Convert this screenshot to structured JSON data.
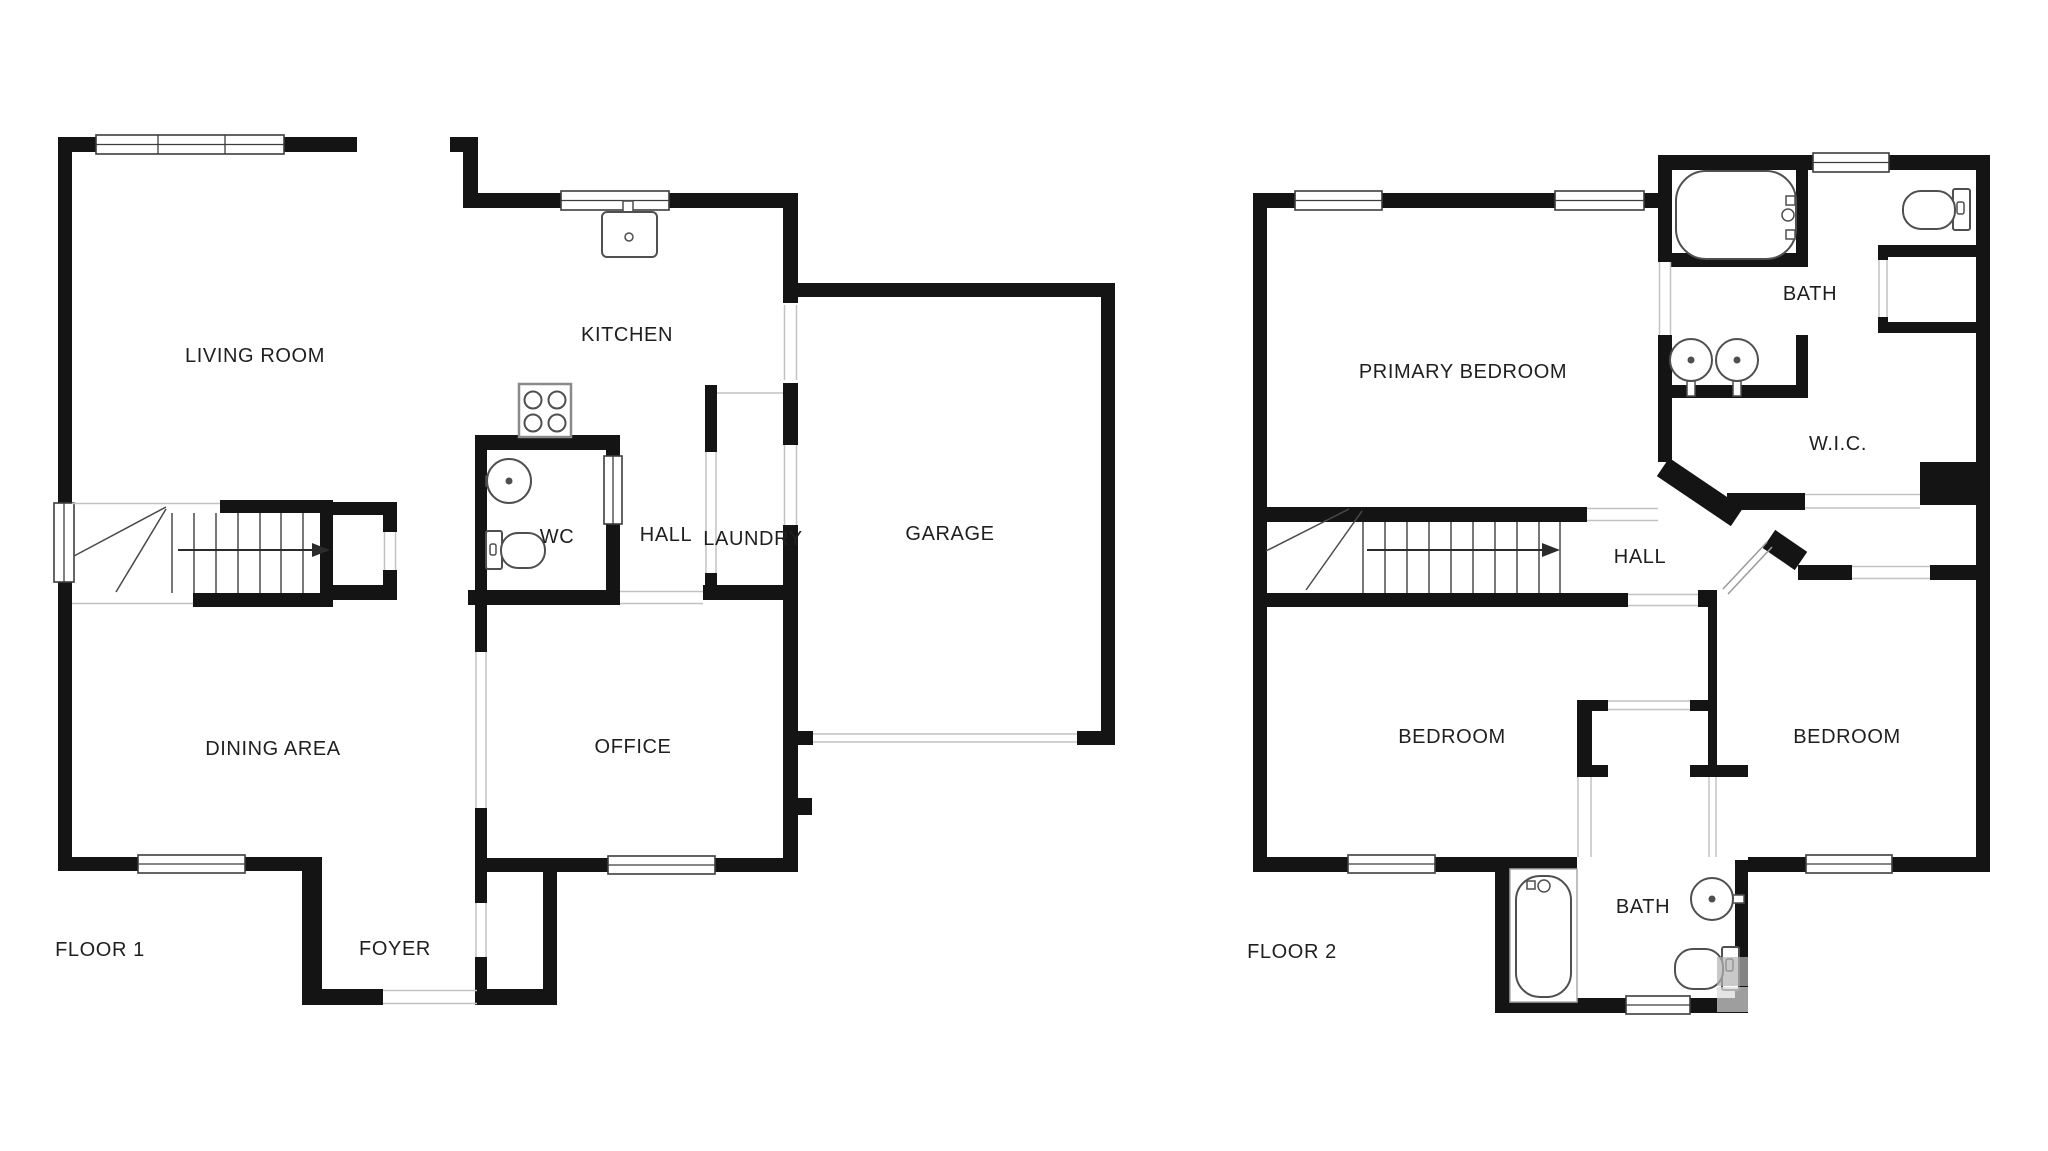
{
  "floor1": {
    "label": "FLOOR 1",
    "rooms": {
      "living_room": "LIVING ROOM",
      "kitchen": "KITCHEN",
      "wc": "WC",
      "hall": "HALL",
      "laundry": "LAUNDRY",
      "garage": "GARAGE",
      "dining_area": "DINING AREA",
      "office": "OFFICE",
      "foyer": "FOYER"
    }
  },
  "floor2": {
    "label": "FLOOR 2",
    "rooms": {
      "primary_bedroom": "PRIMARY BEDROOM",
      "bath_upper": "BATH",
      "wic": "W.I.C.",
      "hall": "HALL",
      "bedroom_left": "BEDROOM",
      "bedroom_right": "BEDROOM",
      "bath_lower": "BATH"
    }
  },
  "colors": {
    "wall": "#141414",
    "fixture_outline": "#4f4f4f",
    "hairline": "#c2c2c2",
    "background": "#ffffff"
  }
}
